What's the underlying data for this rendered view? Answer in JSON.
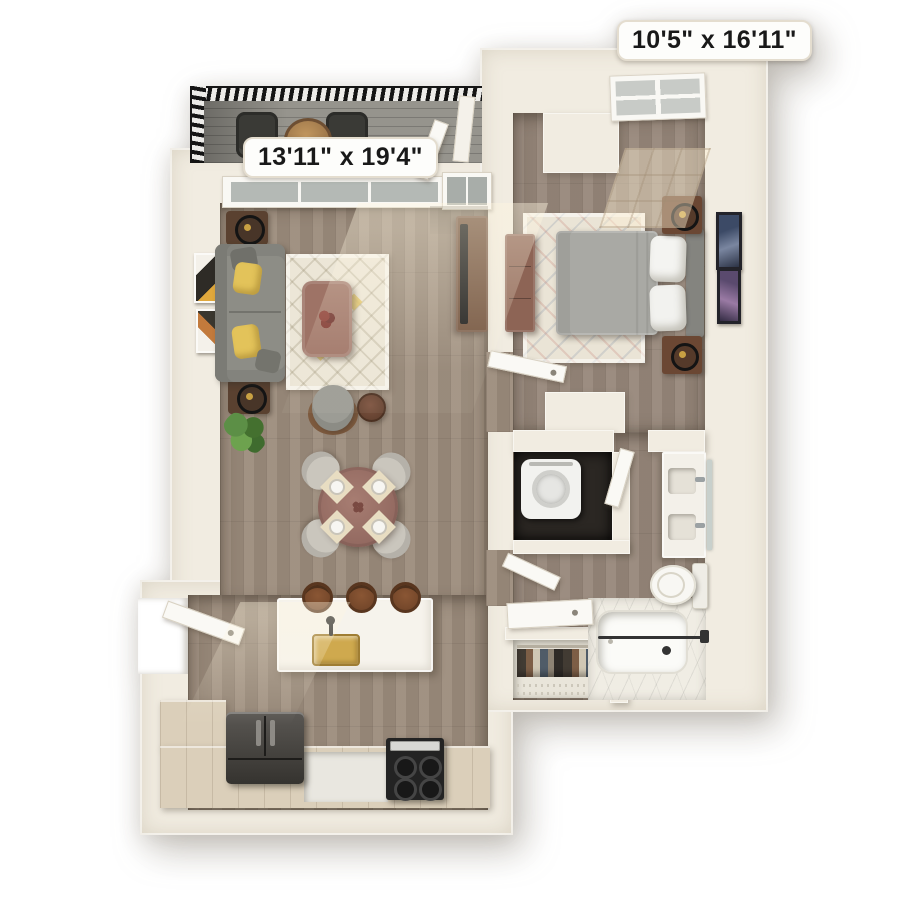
{
  "background": "#ffffff",
  "badges": {
    "living_room": "13'11\" x 19'4\"",
    "bedroom": "10'5\" x 16'11\""
  },
  "rooms": [
    "balcony",
    "living-room",
    "dining-area",
    "kitchen",
    "entry",
    "bedroom",
    "bathroom",
    "laundry-closet",
    "wardrobe-closet"
  ],
  "palette": {
    "bg": "#ffffff",
    "wall": "#f1ece1",
    "floor_wood": "#9c8c7c",
    "floor_bedroom": "#97877a",
    "cabinet_wood": "#dbcfba",
    "balcony_floor": "#96948d",
    "railing": "#161616",
    "island_white": "#f6f3ec",
    "brass": "#cfa94e",
    "sofa": "#8d8d86",
    "pillow_yellow": "#e3c35a",
    "rug_cream": "#ece6d7",
    "rug_bedroom": "#eae4d6",
    "table_mauve": "#9e7366",
    "dining_wood": "#997067",
    "chair_gray": "#cac6bd",
    "stool_brown": "#7b4b2f",
    "tv_brown": "#6f4f3a",
    "bed_gray": "#a9a9a4",
    "headboard": "#84847f",
    "nightstand": "#6b4733",
    "dark_appliance": "#3c3a37",
    "fixture_white": "#f8f7f3",
    "marble": "#f0ede4",
    "closet_dark": "#2b2723",
    "door_white": "#faf9f5",
    "plant_green": "#57863f"
  }
}
